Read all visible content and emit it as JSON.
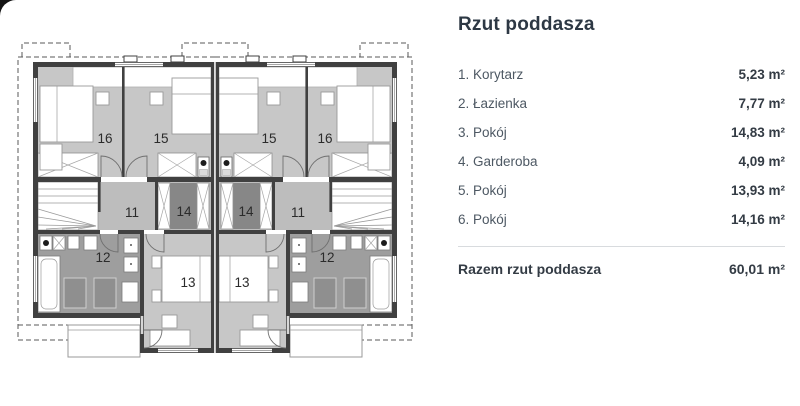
{
  "plan": {
    "room_labels": [
      "16",
      "15",
      "15",
      "16",
      "11",
      "14",
      "14",
      "11",
      "12",
      "13",
      "13",
      "12"
    ]
  },
  "legend": {
    "title": "Rzut poddasza",
    "rows": [
      {
        "name": "1. Korytarz",
        "area": "5,23 m²"
      },
      {
        "name": "2. Łazienka",
        "area": "7,77 m²"
      },
      {
        "name": "3. Pokój",
        "area": "14,83 m²"
      },
      {
        "name": "4. Garderoba",
        "area": "4,09 m²"
      },
      {
        "name": "5. Pokój",
        "area": "13,93 m²"
      },
      {
        "name": "6. Pokój",
        "area": "14,16 m²"
      }
    ],
    "total": {
      "label": "Razem rzut poddasza",
      "area": "60,01 m²"
    }
  },
  "colors": {
    "room_fill": "#c7c7c7",
    "corridor_fill": "#bdbdbd",
    "bathroom_fill": "#9e9e9e",
    "wardrobe_fill": "#878787",
    "wall": "#404040",
    "title_text": "#2d3844"
  }
}
